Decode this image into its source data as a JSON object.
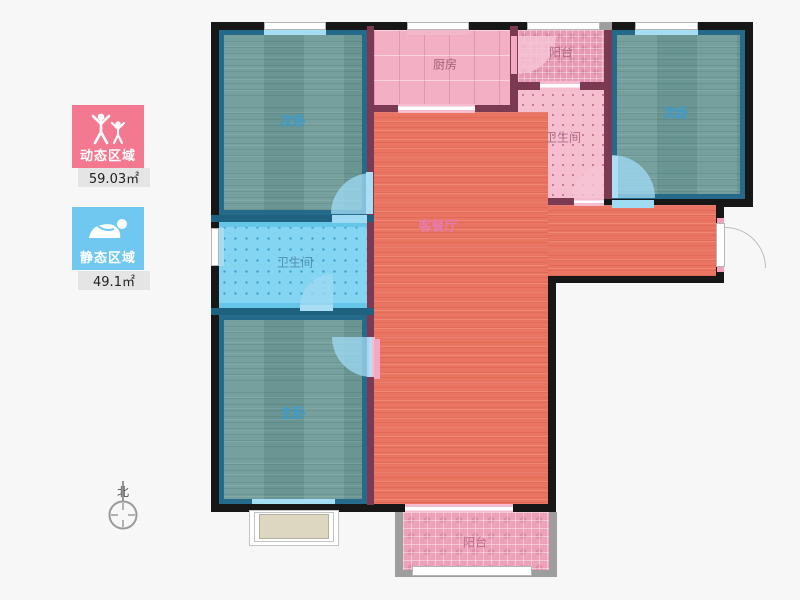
{
  "title": "apartment-floor-plan",
  "legend": {
    "dynamic_area": {
      "label": "动态区域",
      "area": "59.03㎡",
      "color": "#f2798f"
    },
    "static_area": {
      "label": "静态区域",
      "area": "49.1㎡",
      "color": "#70c8f0"
    }
  },
  "compass": {
    "label": "北"
  },
  "rooms": {
    "bedroom_top_left": {
      "label": "次卧",
      "floor_color": "#6f9b98"
    },
    "kitchen": {
      "label": "厨房",
      "floor_color": "#f3afc4"
    },
    "balcony_top": {
      "label": "阳台",
      "floor_color": "#e79ab3"
    },
    "bathroom_top_right": {
      "label": "卫生间",
      "floor_color": "#f5bfd0"
    },
    "bedroom_top_right": {
      "label": "次卧",
      "floor_color": "#6f9b98"
    },
    "living_dining": {
      "label": "客餐厅",
      "floor_color": "#e97461"
    },
    "bathroom_left": {
      "label": "卫生间",
      "floor_color": "#84d5f2"
    },
    "master_bedroom": {
      "label": "主卧",
      "floor_color": "#6f9b98"
    },
    "balcony_bottom": {
      "label": "阳台",
      "floor_color": "#eda2ba"
    }
  },
  "palette": {
    "outer_wall": "#171717",
    "inner_wall_pink": "#7c3a52",
    "inner_wall_blue": "#1e627f",
    "bedroom_border": "#256a8b",
    "label_blue": "#3d9bcd",
    "label_living": "#e87aab"
  }
}
